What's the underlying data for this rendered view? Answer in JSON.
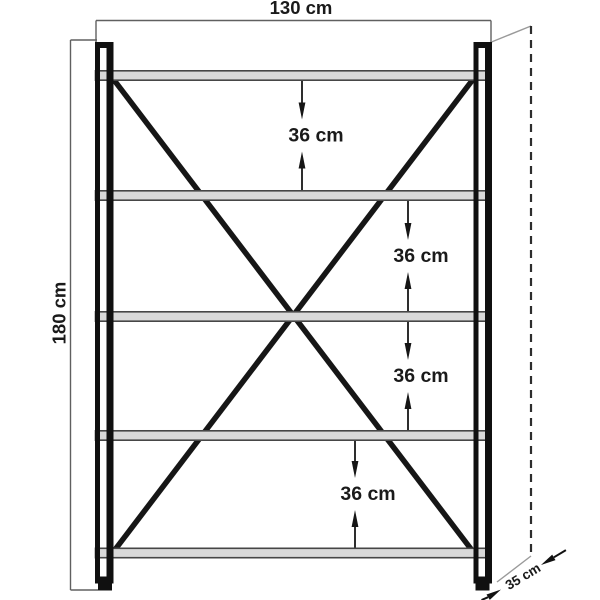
{
  "diagram": {
    "subject": "shelving-unit-dimension-drawing",
    "width_label": "130 cm",
    "height_label": "180 cm",
    "depth_label": "35 cm",
    "gap_labels": [
      "36 cm",
      "36 cm",
      "36 cm",
      "36 cm"
    ],
    "shelf_count": 5,
    "colors": {
      "background": "#ffffff",
      "frame_black": "#101010",
      "shelf_fill": "#d9d9d9",
      "shelf_edge": "#464646",
      "dimension_line": "#606060",
      "depth_line": "#9a9a9a",
      "dashed_line": "#2d2d2d",
      "text": "#1a1a1a"
    }
  }
}
